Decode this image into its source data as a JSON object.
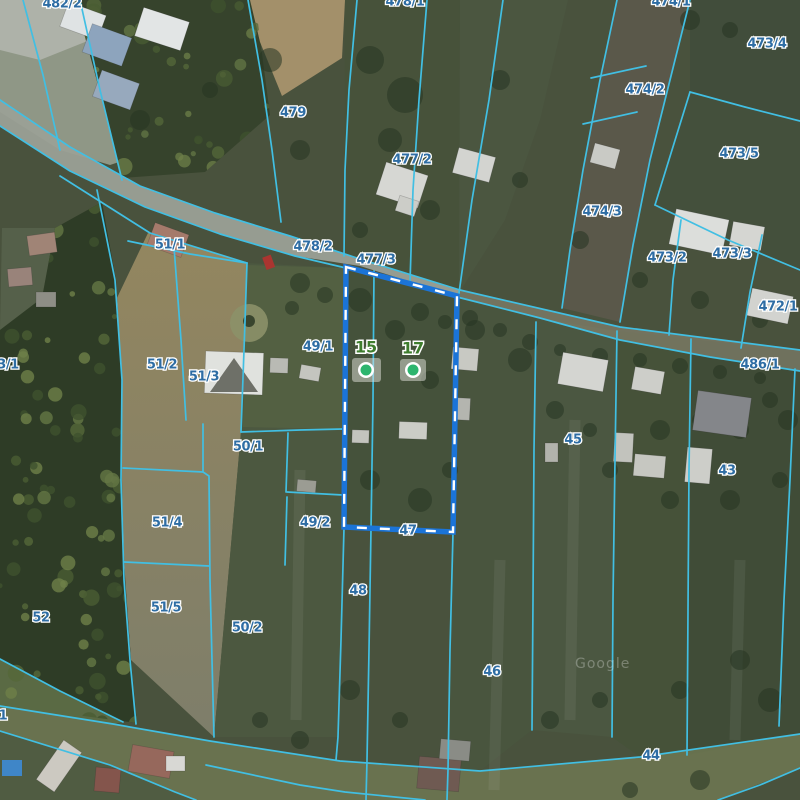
{
  "map": {
    "attribution": "Google",
    "colors": {
      "parcel_line": "#41bfe3",
      "parcel_label": "#2e6da4",
      "address_label": "#3e7d2d",
      "address_dot": "#2db56e",
      "selection_outline": "#1b74d8",
      "selection_dash": "#ffffff"
    },
    "selected_parcel": {
      "label": "47",
      "status": "selected"
    },
    "parcel_labels": [
      {
        "t": "482/2",
        "x": 62,
        "y": 4
      },
      {
        "t": "478/1",
        "x": 405,
        "y": 2
      },
      {
        "t": "474/1",
        "x": 671,
        "y": 2
      },
      {
        "t": "479",
        "x": 293,
        "y": 113
      },
      {
        "t": "473/4",
        "x": 767,
        "y": 44
      },
      {
        "t": "474/2",
        "x": 645,
        "y": 90
      },
      {
        "t": "473/5",
        "x": 739,
        "y": 154
      },
      {
        "t": "477/2",
        "x": 412,
        "y": 160
      },
      {
        "t": "474/3",
        "x": 602,
        "y": 212
      },
      {
        "t": "478/2",
        "x": 313,
        "y": 247
      },
      {
        "t": "477/3",
        "x": 376,
        "y": 260
      },
      {
        "t": "473/2",
        "x": 667,
        "y": 258
      },
      {
        "t": "473/3",
        "x": 732,
        "y": 254
      },
      {
        "t": "472/1",
        "x": 778,
        "y": 307
      },
      {
        "t": "486/1",
        "x": 760,
        "y": 365
      },
      {
        "t": "51/1",
        "x": 170,
        "y": 245
      },
      {
        "t": "3/1",
        "x": 8,
        "y": 365
      },
      {
        "t": "51/2",
        "x": 162,
        "y": 365
      },
      {
        "t": "51/3",
        "x": 204,
        "y": 377
      },
      {
        "t": "49/1",
        "x": 318,
        "y": 347
      },
      {
        "t": "50/1",
        "x": 248,
        "y": 447
      },
      {
        "t": "45",
        "x": 573,
        "y": 440
      },
      {
        "t": "43",
        "x": 727,
        "y": 471
      },
      {
        "t": "49/2",
        "x": 315,
        "y": 523
      },
      {
        "t": "47",
        "x": 408,
        "y": 531
      },
      {
        "t": "51/4",
        "x": 167,
        "y": 523
      },
      {
        "t": "48",
        "x": 358,
        "y": 591
      },
      {
        "t": "51/5",
        "x": 166,
        "y": 608
      },
      {
        "t": "52",
        "x": 41,
        "y": 618
      },
      {
        "t": "50/2",
        "x": 247,
        "y": 628
      },
      {
        "t": "46",
        "x": 492,
        "y": 672
      },
      {
        "t": "44",
        "x": 651,
        "y": 756
      },
      {
        "t": "1",
        "x": 3,
        "y": 716
      }
    ],
    "address_points": [
      {
        "label": "15",
        "x": 366,
        "y": 348,
        "dot_x": 366,
        "dot_y": 370,
        "chip": [
          352,
          358,
          29,
          24
        ]
      },
      {
        "label": "17",
        "x": 413,
        "y": 349,
        "dot_x": 413,
        "dot_y": 370,
        "chip": [
          400,
          359,
          26,
          22
        ]
      }
    ]
  }
}
